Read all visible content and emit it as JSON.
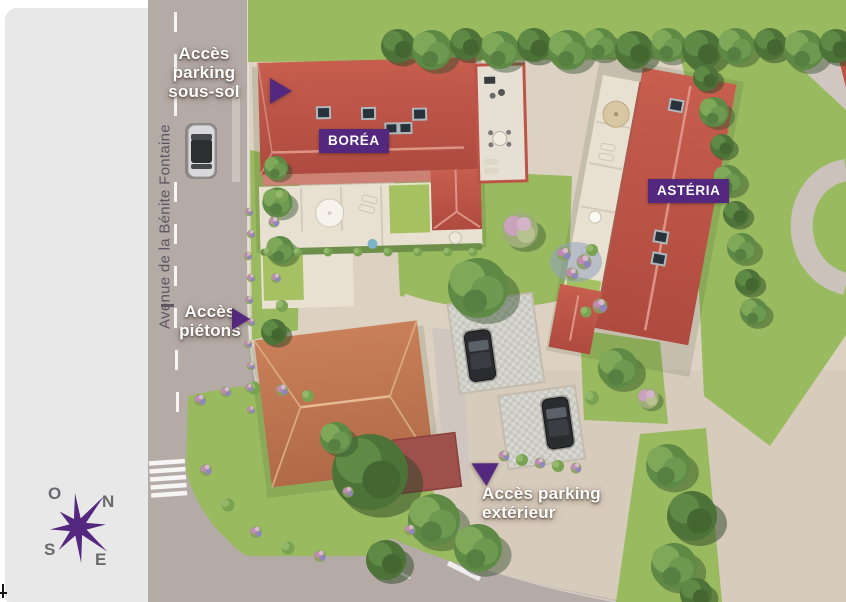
{
  "palette": {
    "purple": "#54287f",
    "road": "#b5aba6",
    "cream": "#ddd2c2",
    "beige": "#d7cbbc",
    "grass": "#9aba60",
    "roof_red": "#bc5547",
    "roof_orange": "#c07a57",
    "roof_maroon": "#9e514c",
    "terrace": "#e8e1d1",
    "panel_gray": "#e9e8e8",
    "street_text": "#5b5662",
    "compass_letter": "#6a6a6d"
  },
  "street": {
    "name": "Avenue de la Bénite Fontaine"
  },
  "buildings": {
    "borea": "BORÉA",
    "asteria": "ASTÉRIA"
  },
  "access": {
    "underground_parking": "Accès\nparking\nsous-sol",
    "pedestrian": "Accès\npiétons",
    "outdoor_parking": "Accès parking\nextérieur"
  },
  "compass": {
    "west": "O",
    "north": "N",
    "south": "S",
    "east": "E"
  }
}
